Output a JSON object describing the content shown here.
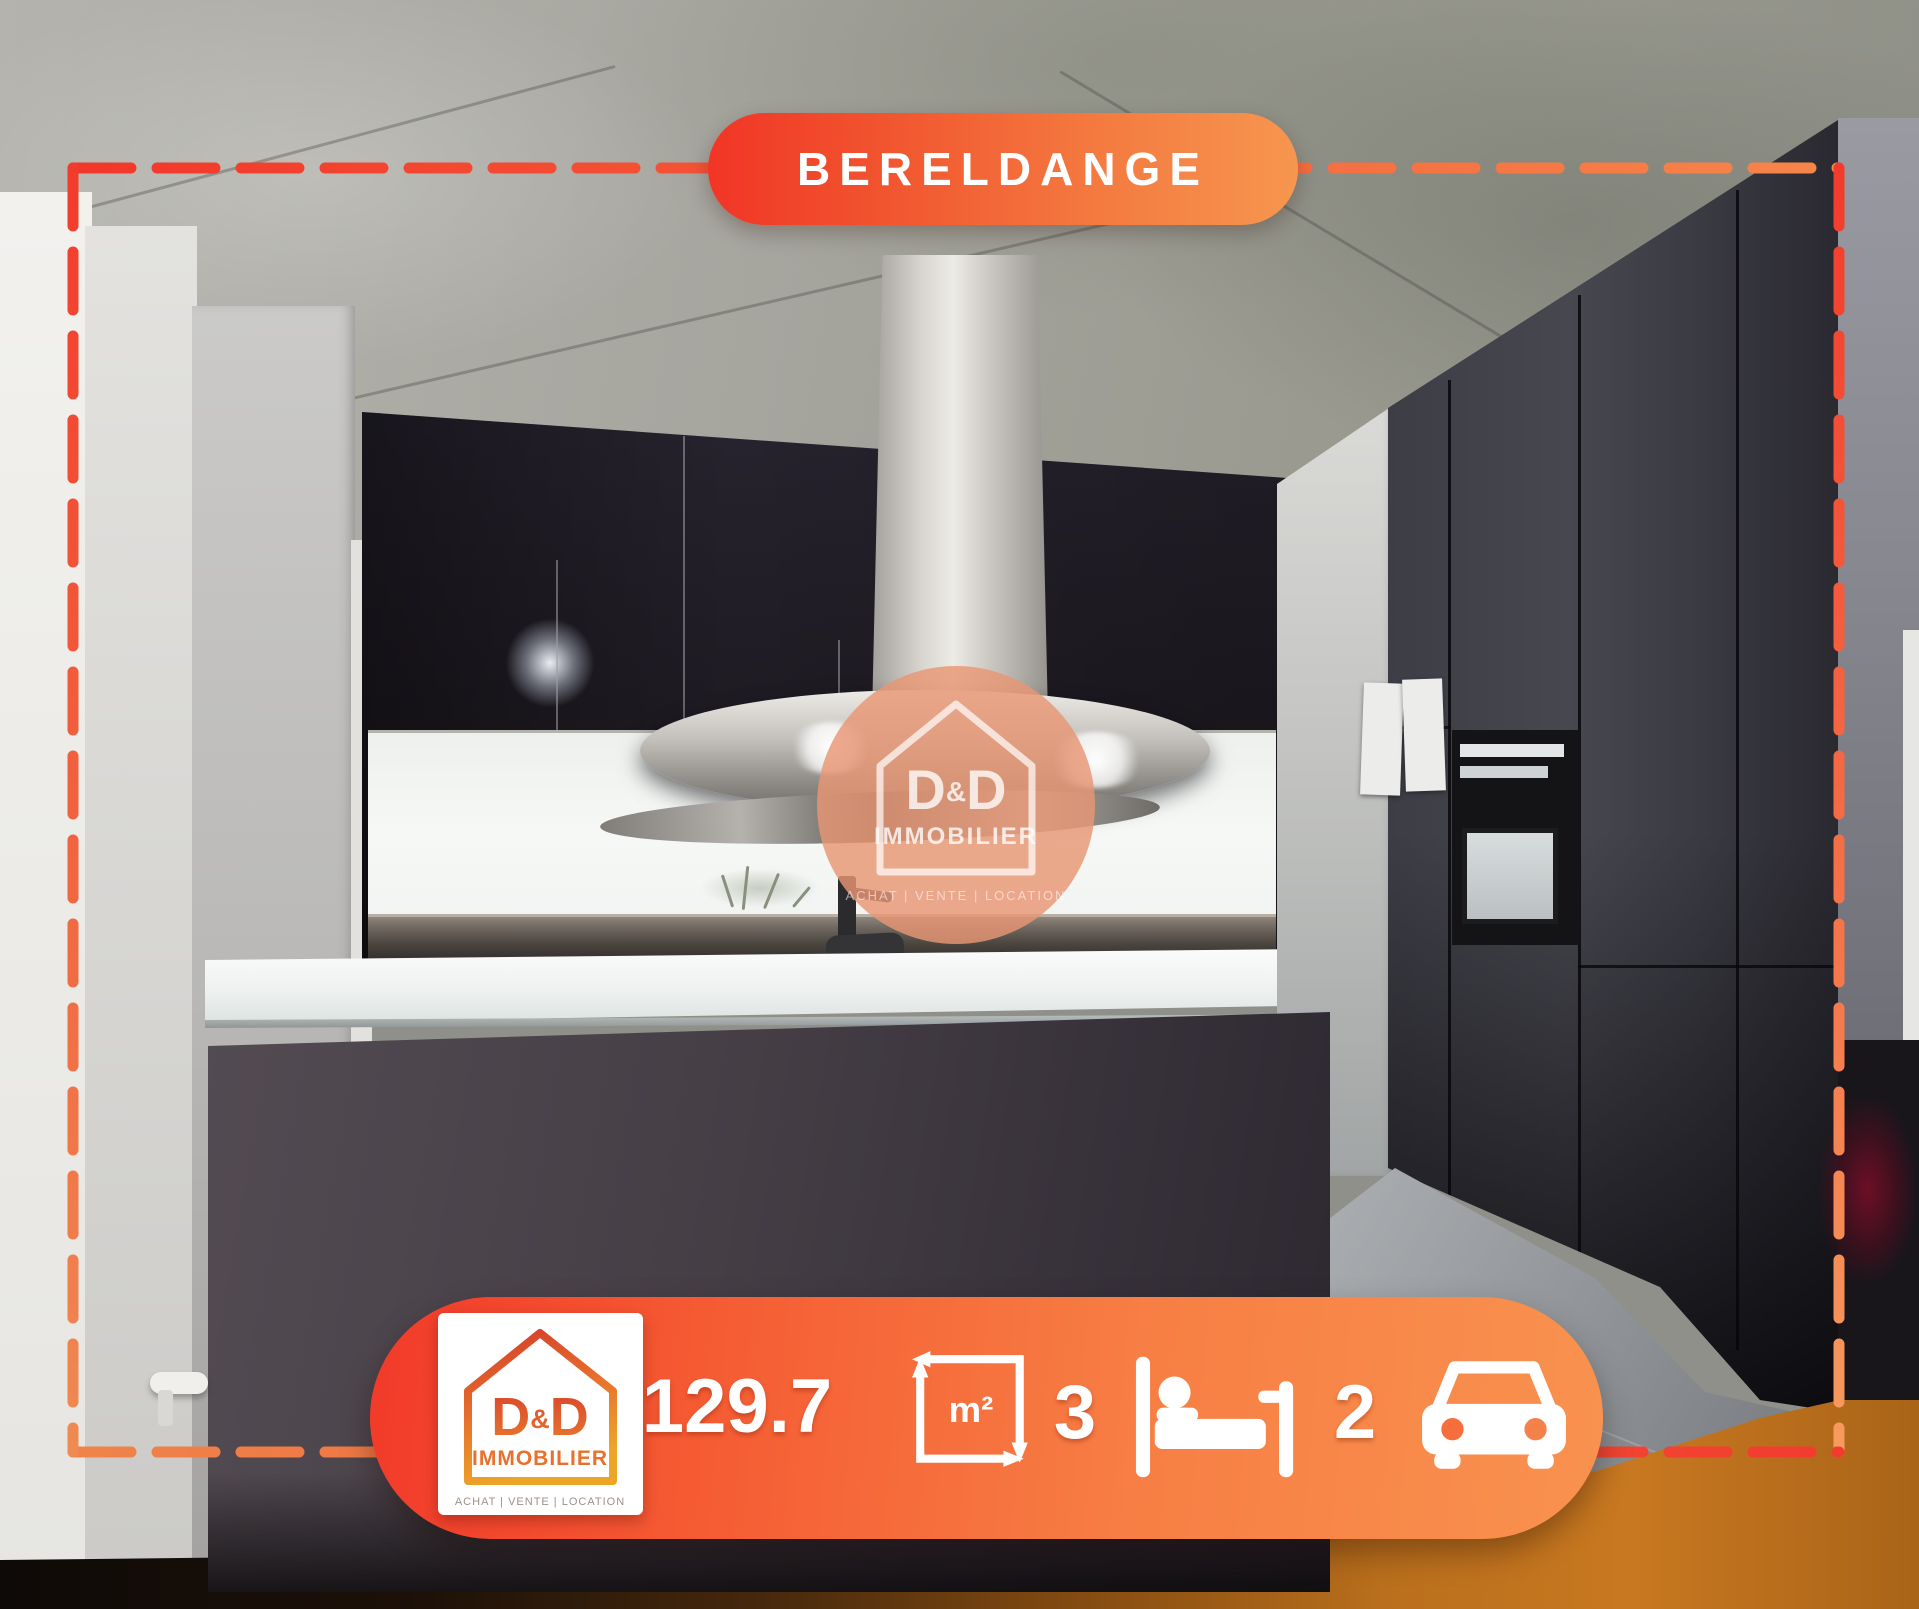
{
  "badge": {
    "location": "BERELDANGE"
  },
  "watermark": {
    "brand_d1": "D",
    "brand_amp": "&",
    "brand_d2": "D",
    "brand_sub": "IMMOBILIER",
    "tagline": "ACHAT  |  VENTE  |  LOCATION"
  },
  "bar": {
    "logo": {
      "brand_d1": "D",
      "brand_amp": "&",
      "brand_d2": "D",
      "brand_sub": "IMMOBILIER",
      "tagline": "ACHAT | VENTE | LOCATION"
    },
    "area_value": "129.7",
    "area_unit": "m²",
    "bedrooms_value": "3",
    "parking_value": "2",
    "icons": {
      "area": "measure-area-icon",
      "bedrooms": "bed-icon",
      "parking": "car-icon"
    }
  },
  "colors": {
    "accent_red": "#f23a2a",
    "accent_orange": "#f78a4c",
    "logo_gradient_top": "#d23b2a",
    "logo_gradient_bottom": "#eda528",
    "watermark_peach": "#e89674"
  }
}
